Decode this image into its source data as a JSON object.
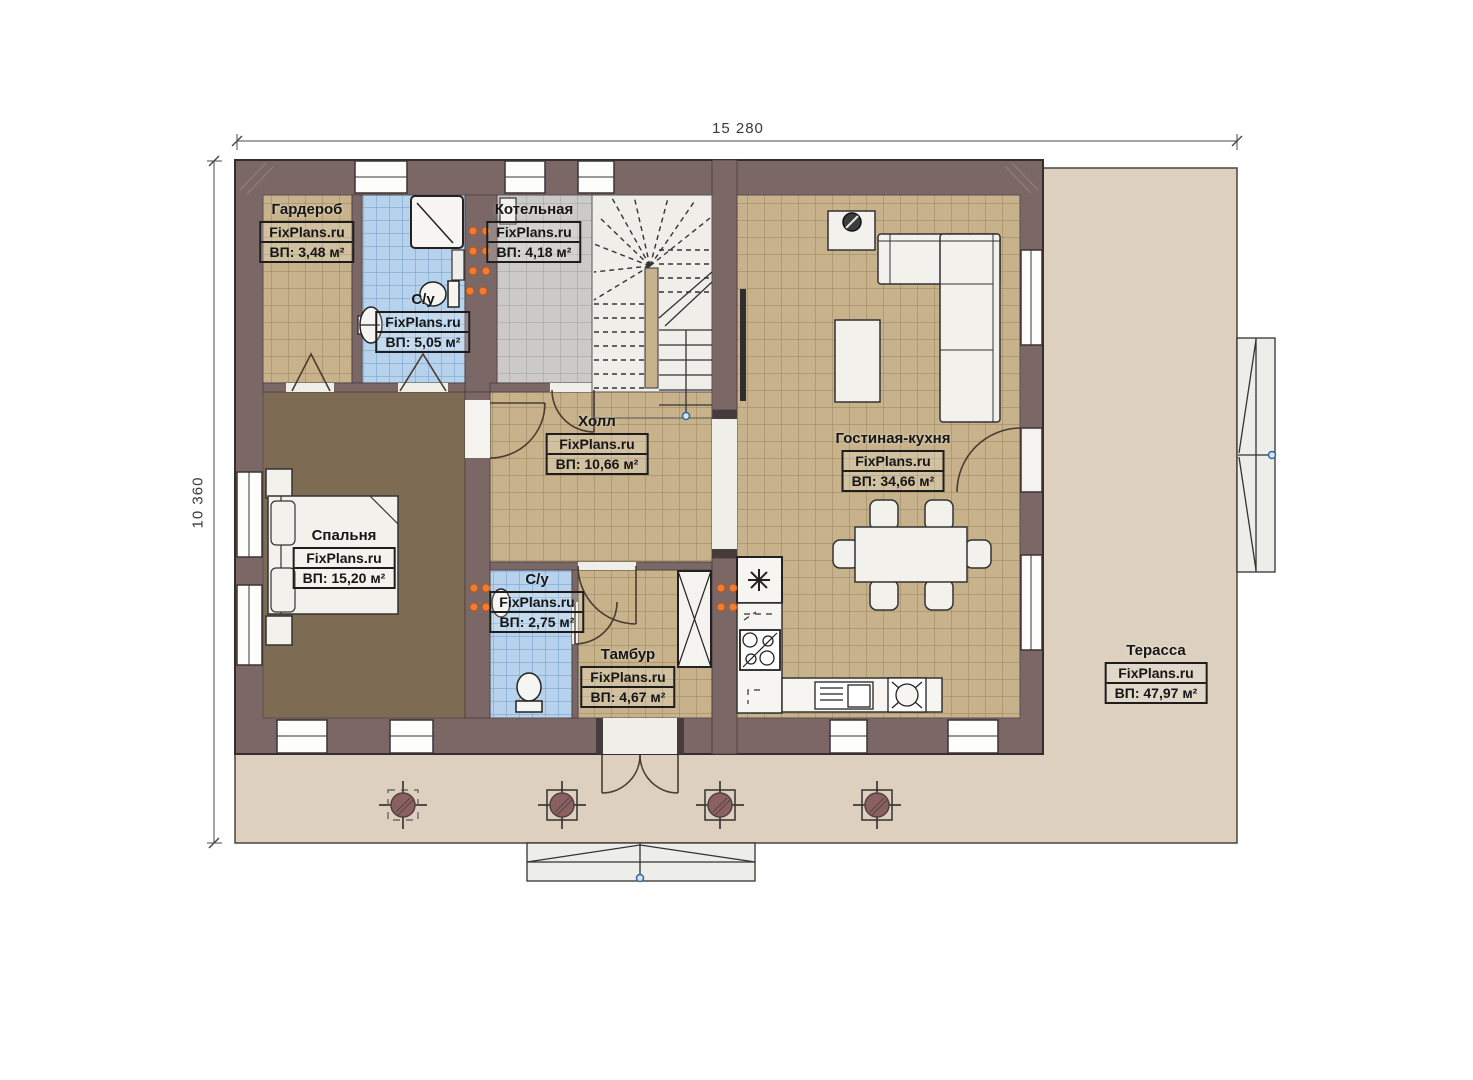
{
  "watermark": "FixPlans.ru",
  "dimensions": {
    "width_label": "15 280",
    "height_label": "10 360"
  },
  "rooms": [
    {
      "name": "Гардероб",
      "area": "ВП: 3,48 м²"
    },
    {
      "name": "Котельная",
      "area": "ВП: 4,18 м²"
    },
    {
      "name": "С/у",
      "area": "ВП: 5,05 м²"
    },
    {
      "name": "Холл",
      "area": "ВП: 10,66 м²"
    },
    {
      "name": "Гостиная-кухня",
      "area": "ВП: 34,66 м²"
    },
    {
      "name": "Спальня",
      "area": "ВП: 15,20 м²"
    },
    {
      "name": "С/у",
      "area": "ВП: 2,75 м²"
    },
    {
      "name": "Тамбур",
      "area": "ВП: 4,67 м²"
    },
    {
      "name": "Терасса",
      "area": "ВП: 47,97 м²"
    }
  ],
  "colors": {
    "wall": "#7c6767",
    "floor_tan": "#c7b28b",
    "floor_blue": "#b6d2ed",
    "floor_gray": "#cbcac6",
    "floor_bedroom": "#7d6b53",
    "terrace": "#ddd0be",
    "radiator": "#f07d33"
  }
}
